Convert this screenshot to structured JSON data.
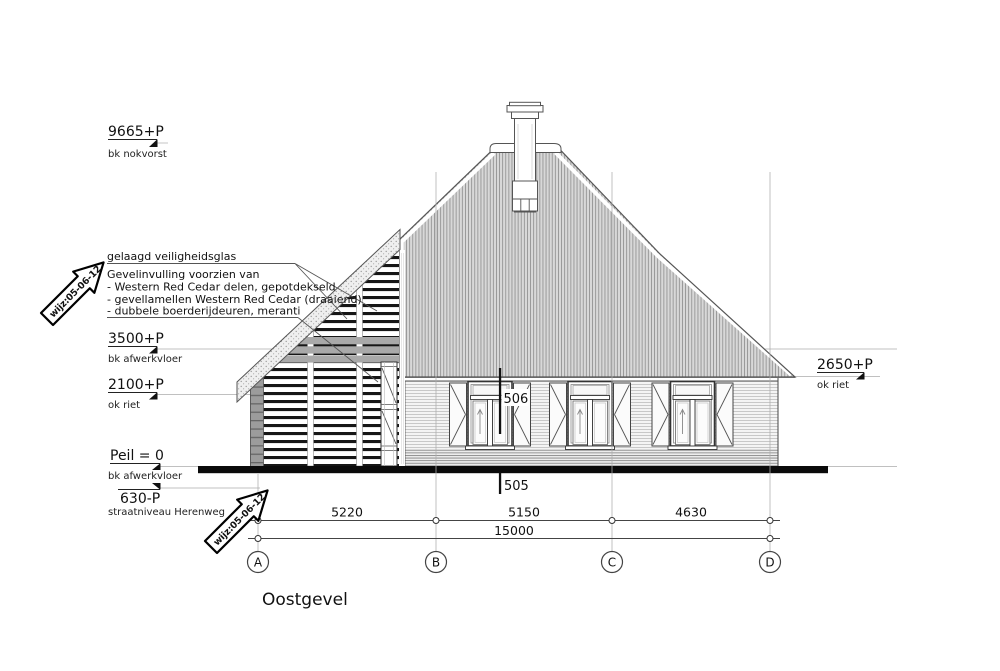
{
  "title": "Oostgevel",
  "levels": {
    "nokvorst": {
      "value": "9665+P",
      "label": "bk nokvorst"
    },
    "afwerkvloer": {
      "value": "3500+P",
      "label": "bk afwerkvloer"
    },
    "okriet_left": {
      "value": "2100+P",
      "label": "ok riet"
    },
    "peil": {
      "value": "Peil = 0",
      "label": "bk afwerkvloer"
    },
    "straatniveau": {
      "value": "630-P",
      "label": "straatniveau Herenweg"
    },
    "okriet_right": {
      "value": "2650+P",
      "label": "ok riet"
    }
  },
  "annotations": {
    "glass": "gelaagd veiligheidsglas",
    "infill_title": "Gevelinvulling voorzien van",
    "infill_items": [
      "- Western Red Cedar delen, gepotdekseld",
      "- gevellamellen Western Red Cedar (draaiend)",
      "- dubbele boerderijdeuren, meranti"
    ]
  },
  "revision_stamp": "wijz:05-06-12",
  "section_markers": {
    "upper": "506",
    "lower": "505"
  },
  "dimensions": {
    "segments": [
      "5220",
      "5150",
      "4630"
    ],
    "total": "15000"
  },
  "grid_labels": [
    "A",
    "B",
    "C",
    "D"
  ],
  "colors": {
    "line": "#555555",
    "ground_bar": "#0a0a0a",
    "roof_fill": "#d8d8d8",
    "roof_hatch": "#949494",
    "louvre_dark": "#161616",
    "gray_band": "#a9a9a9",
    "faint_line": "#c0c0c0",
    "grid_line": "#adadad"
  }
}
